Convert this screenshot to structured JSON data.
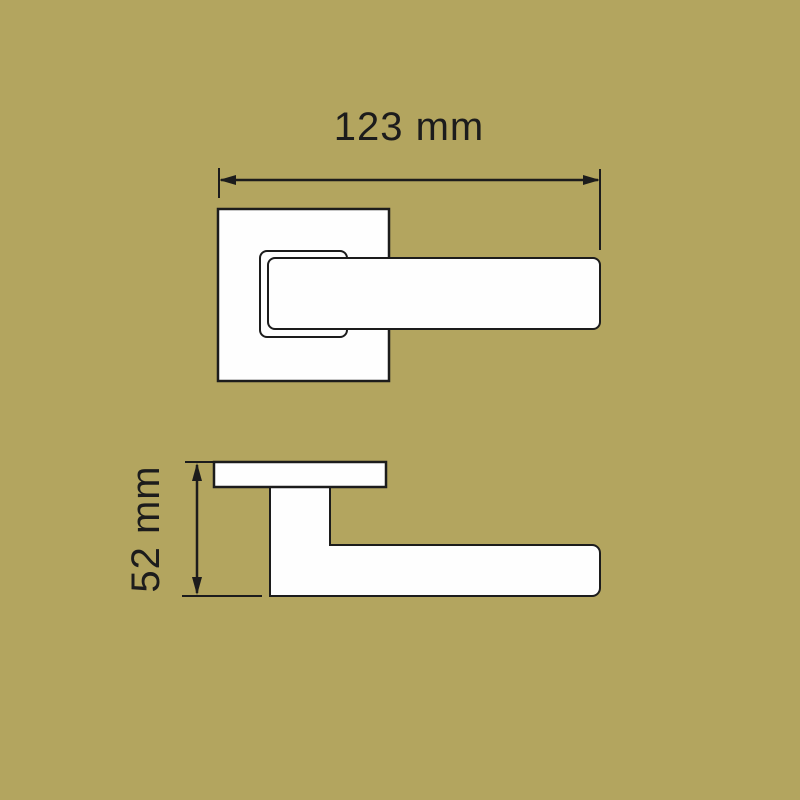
{
  "dimensions": {
    "width": {
      "label": "123 mm",
      "value": 123,
      "unit": "mm"
    },
    "height": {
      "label": "52 mm",
      "value": 52,
      "unit": "mm"
    }
  },
  "colors": {
    "background": "#b3a55f",
    "line": "#1c1c1c",
    "shape_fill": "#fefefe"
  }
}
